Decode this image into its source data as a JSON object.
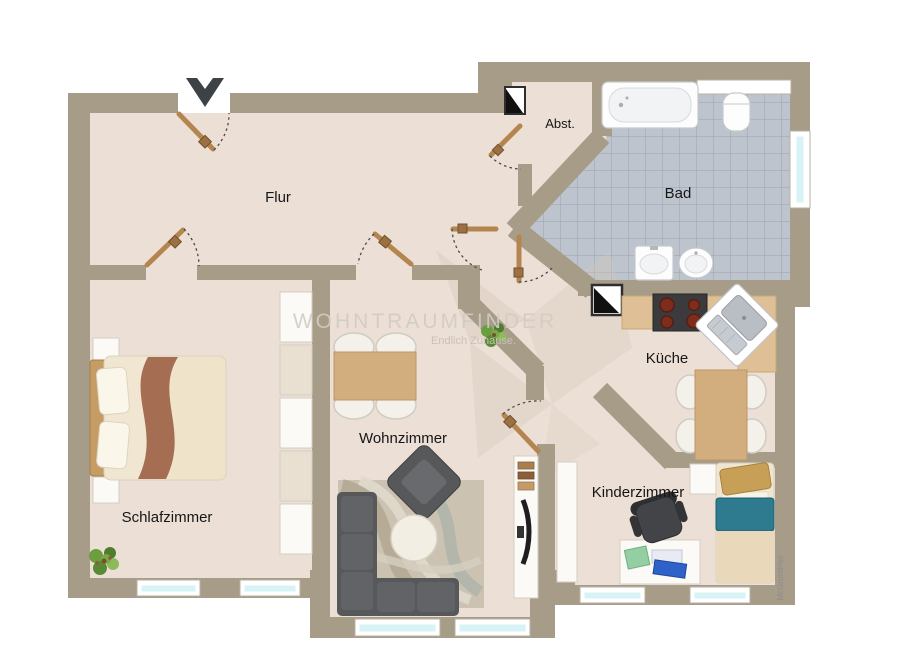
{
  "rooms": {
    "flur": {
      "label": "Flur"
    },
    "abstellraum": {
      "label": "Abst."
    },
    "bad": {
      "label": "Bad"
    },
    "kueche": {
      "label": "Küche"
    },
    "wohnzimmer": {
      "label": "Wohnzimmer"
    },
    "schlafzimmer": {
      "label": "Schlafzimmer"
    },
    "kinderzimmer": {
      "label": "Kinderzimmer"
    }
  },
  "watermark": {
    "title": "WOHNTRAUMFINDER",
    "subtitle": "Endlich Zuhause.",
    "credit": "McGrundriss"
  },
  "icons": {
    "north_arrow": "north-arrow-icon",
    "shaft": "shaft-icon",
    "plant": "plant-icon"
  },
  "colors": {
    "wall": "#a69c87",
    "floor": "#ecdfd6",
    "tile": "#bdc4cd",
    "tile_line": "#9aa2ac",
    "glass": "#d8f3f6",
    "door": "#b5854f",
    "counter": "#debf96",
    "table": "#d2ad7e",
    "sofa": "#57585a",
    "bed_blanket": "#efe3c9",
    "bed_fold": "#a56e53",
    "kid_blanket": "#2e7a8e",
    "rug": "#cbc2b2",
    "plant": "#6b9e3f",
    "watermark": "#d2ccc5"
  }
}
